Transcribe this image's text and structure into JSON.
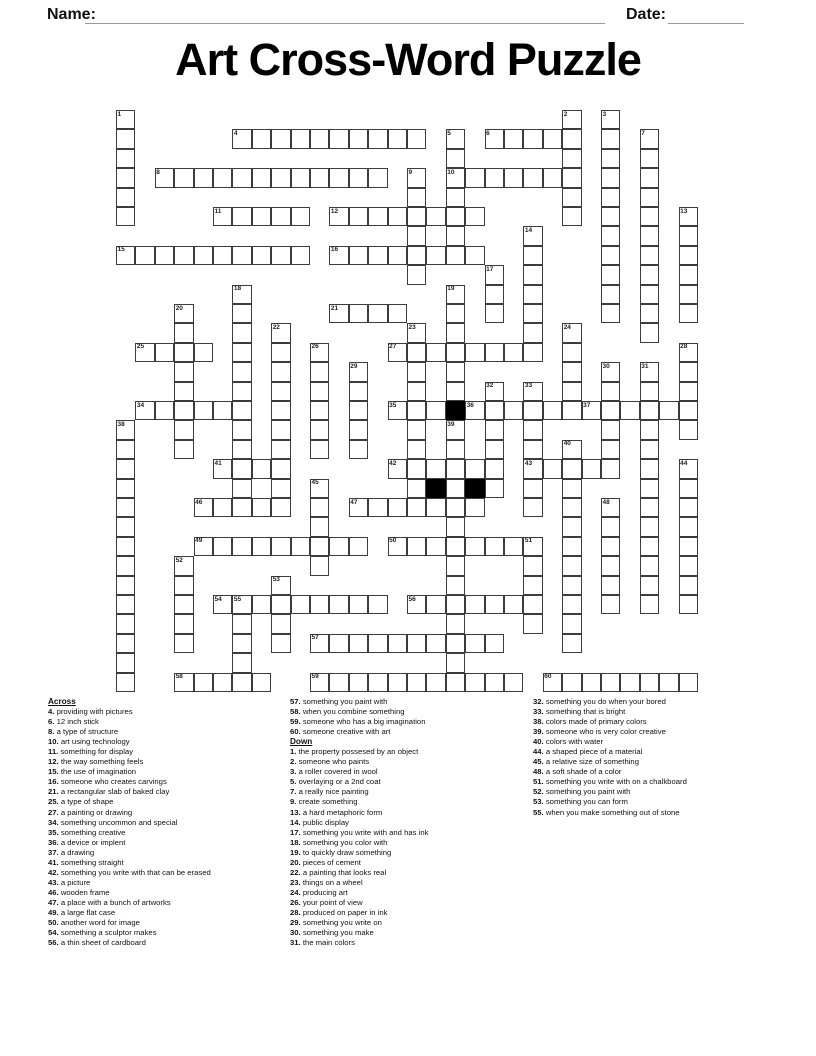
{
  "header": {
    "name_label": "Name:",
    "date_label": "Date:"
  },
  "title": "Art Cross-Word Puzzle",
  "grid": {
    "cell_size": 19.4,
    "origin_x": 116,
    "origin_y": 110,
    "rows": 30,
    "cols": 30,
    "line_color": "#3c3c3c",
    "black_color": "#000000",
    "entries": [
      {
        "n": 4,
        "dir": "A",
        "c": 6,
        "r": 1,
        "len": 10
      },
      {
        "n": 6,
        "dir": "A",
        "c": 19,
        "r": 1,
        "len": 5
      },
      {
        "n": 8,
        "dir": "A",
        "c": 2,
        "r": 3,
        "len": 12
      },
      {
        "n": 10,
        "dir": "A",
        "c": 17,
        "r": 3,
        "len": 7
      },
      {
        "n": 11,
        "dir": "A",
        "c": 5,
        "r": 5,
        "len": 5
      },
      {
        "n": 12,
        "dir": "A",
        "c": 11,
        "r": 5,
        "len": 8
      },
      {
        "n": 15,
        "dir": "A",
        "c": 0,
        "r": 7,
        "len": 10
      },
      {
        "n": 16,
        "dir": "A",
        "c": 11,
        "r": 7,
        "len": 8
      },
      {
        "n": 21,
        "dir": "A",
        "c": 11,
        "r": 10,
        "len": 4
      },
      {
        "n": 25,
        "dir": "A",
        "c": 1,
        "r": 12,
        "len": 4
      },
      {
        "n": 27,
        "dir": "A",
        "c": 14,
        "r": 12,
        "len": 8
      },
      {
        "n": 34,
        "dir": "A",
        "c": 1,
        "r": 15,
        "len": 6
      },
      {
        "n": 35,
        "dir": "A",
        "c": 14,
        "r": 15,
        "len": 3
      },
      {
        "n": 36,
        "dir": "A",
        "c": 18,
        "r": 15,
        "len": 6
      },
      {
        "n": 37,
        "dir": "A",
        "c": 24,
        "r": 15,
        "len": 6
      },
      {
        "n": 41,
        "dir": "A",
        "c": 5,
        "r": 18,
        "len": 4
      },
      {
        "n": 42,
        "dir": "A",
        "c": 14,
        "r": 18,
        "len": 6
      },
      {
        "n": 43,
        "dir": "A",
        "c": 21,
        "r": 18,
        "len": 5
      },
      {
        "n": 46,
        "dir": "A",
        "c": 4,
        "r": 20,
        "len": 5
      },
      {
        "n": 47,
        "dir": "A",
        "c": 12,
        "r": 20,
        "len": 7
      },
      {
        "n": 49,
        "dir": "A",
        "c": 4,
        "r": 22,
        "len": 9
      },
      {
        "n": 50,
        "dir": "A",
        "c": 14,
        "r": 22,
        "len": 7
      },
      {
        "n": 54,
        "dir": "A",
        "c": 5,
        "r": 25,
        "len": 9
      },
      {
        "n": 56,
        "dir": "A",
        "c": 15,
        "r": 25,
        "len": 6
      },
      {
        "n": 57,
        "dir": "A",
        "c": 10,
        "r": 27,
        "len": 10
      },
      {
        "n": 58,
        "dir": "A",
        "c": 3,
        "r": 29,
        "len": 5
      },
      {
        "n": 59,
        "dir": "A",
        "c": 10,
        "r": 29,
        "len": 11
      },
      {
        "n": 60,
        "dir": "A",
        "c": 22,
        "r": 29,
        "len": 8
      },
      {
        "n": 1,
        "dir": "D",
        "c": 0,
        "r": 0,
        "len": 6
      },
      {
        "n": 2,
        "dir": "D",
        "c": 23,
        "r": 0,
        "len": 6
      },
      {
        "n": 3,
        "dir": "D",
        "c": 25,
        "r": 0,
        "len": 11
      },
      {
        "n": 5,
        "dir": "D",
        "c": 17,
        "r": 1,
        "len": 7
      },
      {
        "n": 7,
        "dir": "D",
        "c": 27,
        "r": 1,
        "len": 11
      },
      {
        "n": 9,
        "dir": "D",
        "c": 15,
        "r": 3,
        "len": 6
      },
      {
        "n": 13,
        "dir": "D",
        "c": 29,
        "r": 5,
        "len": 6
      },
      {
        "n": 14,
        "dir": "D",
        "c": 21,
        "r": 6,
        "len": 7
      },
      {
        "n": 17,
        "dir": "D",
        "c": 19,
        "r": 8,
        "len": 3
      },
      {
        "n": 18,
        "dir": "D",
        "c": 6,
        "r": 9,
        "len": 12
      },
      {
        "n": 19,
        "dir": "D",
        "c": 17,
        "r": 9,
        "len": 6
      },
      {
        "n": 20,
        "dir": "D",
        "c": 3,
        "r": 10,
        "len": 8
      },
      {
        "n": 22,
        "dir": "D",
        "c": 8,
        "r": 11,
        "len": 9
      },
      {
        "n": 23,
        "dir": "D",
        "c": 15,
        "r": 11,
        "len": 9
      },
      {
        "n": 24,
        "dir": "D",
        "c": 23,
        "r": 11,
        "len": 5
      },
      {
        "n": 26,
        "dir": "D",
        "c": 10,
        "r": 12,
        "len": 6
      },
      {
        "n": 28,
        "dir": "D",
        "c": 29,
        "r": 12,
        "len": 5
      },
      {
        "n": 29,
        "dir": "D",
        "c": 12,
        "r": 13,
        "len": 5
      },
      {
        "n": 30,
        "dir": "D",
        "c": 25,
        "r": 13,
        "len": 5
      },
      {
        "n": 31,
        "dir": "D",
        "c": 27,
        "r": 13,
        "len": 13
      },
      {
        "n": 32,
        "dir": "D",
        "c": 19,
        "r": 14,
        "len": 6
      },
      {
        "n": 33,
        "dir": "D",
        "c": 21,
        "r": 14,
        "len": 7
      },
      {
        "n": 38,
        "dir": "D",
        "c": 0,
        "r": 16,
        "len": 14
      },
      {
        "n": 39,
        "dir": "D",
        "c": 17,
        "r": 16,
        "len": 14
      },
      {
        "n": 40,
        "dir": "D",
        "c": 23,
        "r": 17,
        "len": 11
      },
      {
        "n": 44,
        "dir": "D",
        "c": 29,
        "r": 18,
        "len": 8
      },
      {
        "n": 45,
        "dir": "D",
        "c": 10,
        "r": 19,
        "len": 5
      },
      {
        "n": 48,
        "dir": "D",
        "c": 25,
        "r": 20,
        "len": 6
      },
      {
        "n": 51,
        "dir": "D",
        "c": 21,
        "r": 22,
        "len": 5
      },
      {
        "n": 52,
        "dir": "D",
        "c": 3,
        "r": 23,
        "len": 5
      },
      {
        "n": 53,
        "dir": "D",
        "c": 8,
        "r": 24,
        "len": 4
      },
      {
        "n": 55,
        "dir": "D",
        "c": 6,
        "r": 25,
        "len": 5
      }
    ],
    "black_cells": [
      {
        "c": 17,
        "r": 15
      },
      {
        "c": 16,
        "r": 19
      },
      {
        "c": 18,
        "r": 19
      }
    ]
  },
  "clues": {
    "across_label": "Across",
    "down_label": "Down",
    "across": [
      {
        "n": 4,
        "text": "providing with pictures"
      },
      {
        "n": 6,
        "text": "12 inch stick"
      },
      {
        "n": 8,
        "text": "a type of structure"
      },
      {
        "n": 10,
        "text": "art using technology"
      },
      {
        "n": 11,
        "text": "something for display"
      },
      {
        "n": 12,
        "text": "the way something feels"
      },
      {
        "n": 15,
        "text": "the use of imagination"
      },
      {
        "n": 16,
        "text": "someone who creates carvings"
      },
      {
        "n": 21,
        "text": "a rectangular slab of baked clay"
      },
      {
        "n": 25,
        "text": "a type of shape"
      },
      {
        "n": 27,
        "text": "a painting or drawing"
      },
      {
        "n": 34,
        "text": "something uncommon and special"
      },
      {
        "n": 35,
        "text": "something creative"
      },
      {
        "n": 36,
        "text": "a device or implent"
      },
      {
        "n": 37,
        "text": "a drawing"
      },
      {
        "n": 41,
        "text": "something straight"
      },
      {
        "n": 42,
        "text": "something you write with that can be erased"
      },
      {
        "n": 43,
        "text": "a picture"
      },
      {
        "n": 46,
        "text": "wooden frame"
      },
      {
        "n": 47,
        "text": "a place with a bunch of artworks"
      },
      {
        "n": 49,
        "text": "a large flat case"
      },
      {
        "n": 50,
        "text": "another word for image"
      },
      {
        "n": 54,
        "text": "something a sculptor makes"
      },
      {
        "n": 56,
        "text": "a thin sheet of cardboard"
      },
      {
        "n": 57,
        "text": "something you paint with"
      },
      {
        "n": 58,
        "text": "when you combine something"
      },
      {
        "n": 59,
        "text": "someone who has a big imagination"
      },
      {
        "n": 60,
        "text": "someone creative with art"
      }
    ],
    "down": [
      {
        "n": 1,
        "text": "the property possesed by an object"
      },
      {
        "n": 2,
        "text": "someone who paints"
      },
      {
        "n": 3,
        "text": "a roller covered in wool"
      },
      {
        "n": 5,
        "text": "overlaying or a 2nd coat"
      },
      {
        "n": 7,
        "text": "a really nice painting"
      },
      {
        "n": 9,
        "text": "create something"
      },
      {
        "n": 13,
        "text": "a hard metaphoric form"
      },
      {
        "n": 14,
        "text": "public display"
      },
      {
        "n": 17,
        "text": "something you write with and has ink"
      },
      {
        "n": 18,
        "text": "something you color with"
      },
      {
        "n": 19,
        "text": "to quickly draw something"
      },
      {
        "n": 20,
        "text": "pieces of cement"
      },
      {
        "n": 22,
        "text": "a painting that looks real"
      },
      {
        "n": 23,
        "text": "things on a wheel"
      },
      {
        "n": 24,
        "text": "producing art"
      },
      {
        "n": 26,
        "text": "your point of view"
      },
      {
        "n": 28,
        "text": "produced on paper in ink"
      },
      {
        "n": 29,
        "text": "something you write on"
      },
      {
        "n": 30,
        "text": "something you make"
      },
      {
        "n": 31,
        "text": "the main colors"
      },
      {
        "n": 32,
        "text": "something you do when your bored"
      },
      {
        "n": 33,
        "text": "something that is bright"
      },
      {
        "n": 38,
        "text": "colors made of primary colors"
      },
      {
        "n": 39,
        "text": "someone who is very color creative"
      },
      {
        "n": 40,
        "text": "colors with water"
      },
      {
        "n": 44,
        "text": "a shaped piece of a material"
      },
      {
        "n": 45,
        "text": "a relative size of something"
      },
      {
        "n": 48,
        "text": "a soft shade of a color"
      },
      {
        "n": 51,
        "text": "something you write with on a chalkboard"
      },
      {
        "n": 52,
        "text": "something you paint with"
      },
      {
        "n": 53,
        "text": "something you can form"
      },
      {
        "n": 55,
        "text": "when you make something out of stone"
      }
    ],
    "layout": {
      "col1_across_count": 24,
      "col2_down_count": 20,
      "col_lefts": [
        48,
        290,
        533
      ],
      "col_widths": [
        238,
        240,
        262
      ]
    }
  }
}
